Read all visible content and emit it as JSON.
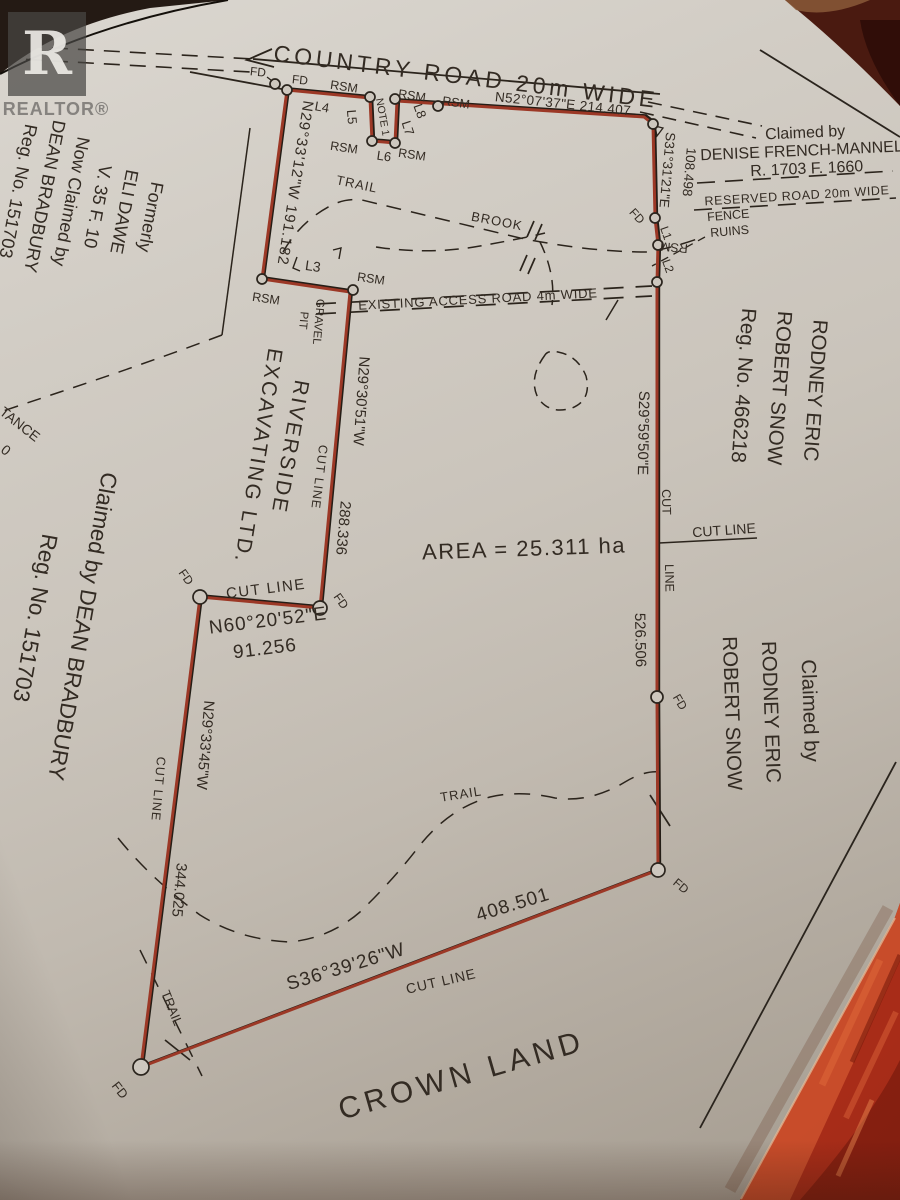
{
  "watermark": {
    "logo_letter": "R",
    "brand": "REALTOR®"
  },
  "roads": {
    "country_road": "COUNTRY ROAD 20m WIDE",
    "reserved_road": "RESERVED ROAD 20m WIDE",
    "access_road": "EXISTING ACCESS ROAD 4m WIDE"
  },
  "parcel": {
    "area": "AREA = 25.311 ha",
    "owner_line1": "RIVERSIDE",
    "owner_line2": "EXCAVATING LTD.",
    "crown_land": "CROWN LAND"
  },
  "bearings": {
    "north": "N52°07'37\"E  214.407",
    "northeast": "S31°31'21\"E",
    "northeast_dist": "108.498",
    "east": "S29°59'50\"E",
    "east_dist": "526.506",
    "south": "S36°39'26\"W",
    "south_dist": "408.501",
    "southwest": "N29°33'45\"W",
    "southwest_dist": "344.025",
    "cutline": "N60°20'52\"E",
    "cutline_dist": "91.256",
    "west_mid": "N29°30'51\"W",
    "west_mid_dist": "288.336",
    "west_upper": "N29°33'12\"W 191.182"
  },
  "markers": {
    "fd": "FD",
    "rsm": "RSM",
    "l1": "L1",
    "l2": "L2",
    "l3": "L3",
    "l4": "L4",
    "l5": "L5",
    "l6": "L6",
    "l7": "L7",
    "l8": "L8",
    "note1": "NOTE 1"
  },
  "features": {
    "trail": "TRAIL",
    "brook": "BROOK",
    "fence_line1": "FENCE",
    "fence_line2": "RUINS",
    "gravel_line1": "GRAVEL",
    "gravel_line2": "PIT",
    "cut_line": "CUT LINE",
    "cut": "CUT",
    "line": "LINE"
  },
  "claims": {
    "denise": {
      "l1": "Claimed by",
      "l2": "DENISE FRENCH-MANNELL",
      "l3": "R. 1703 F. 1660"
    },
    "formerly": {
      "l1": "Formerly",
      "l2": "ELI DAWE",
      "l3": "V. 35 F. 10",
      "l4": "Now Claimed by",
      "l5": "DEAN BRADBURY",
      "l6": "Reg. No. 151703"
    },
    "snow_reg": {
      "l1": "RODNEY ERIC",
      "l2": "ROBERT SNOW",
      "l3": "Reg. No. 466218"
    },
    "snow_claim": {
      "l1": "Claimed by",
      "l2": "RODNEY ERIC",
      "l3": "ROBERT SNOW"
    },
    "bradbury": {
      "l1": "Claimed by DEAN BRADBURY",
      "l2": "Reg. No. 151703"
    }
  },
  "fragments": {
    "edge_text": "TANCE",
    "edge_digit": "0"
  }
}
